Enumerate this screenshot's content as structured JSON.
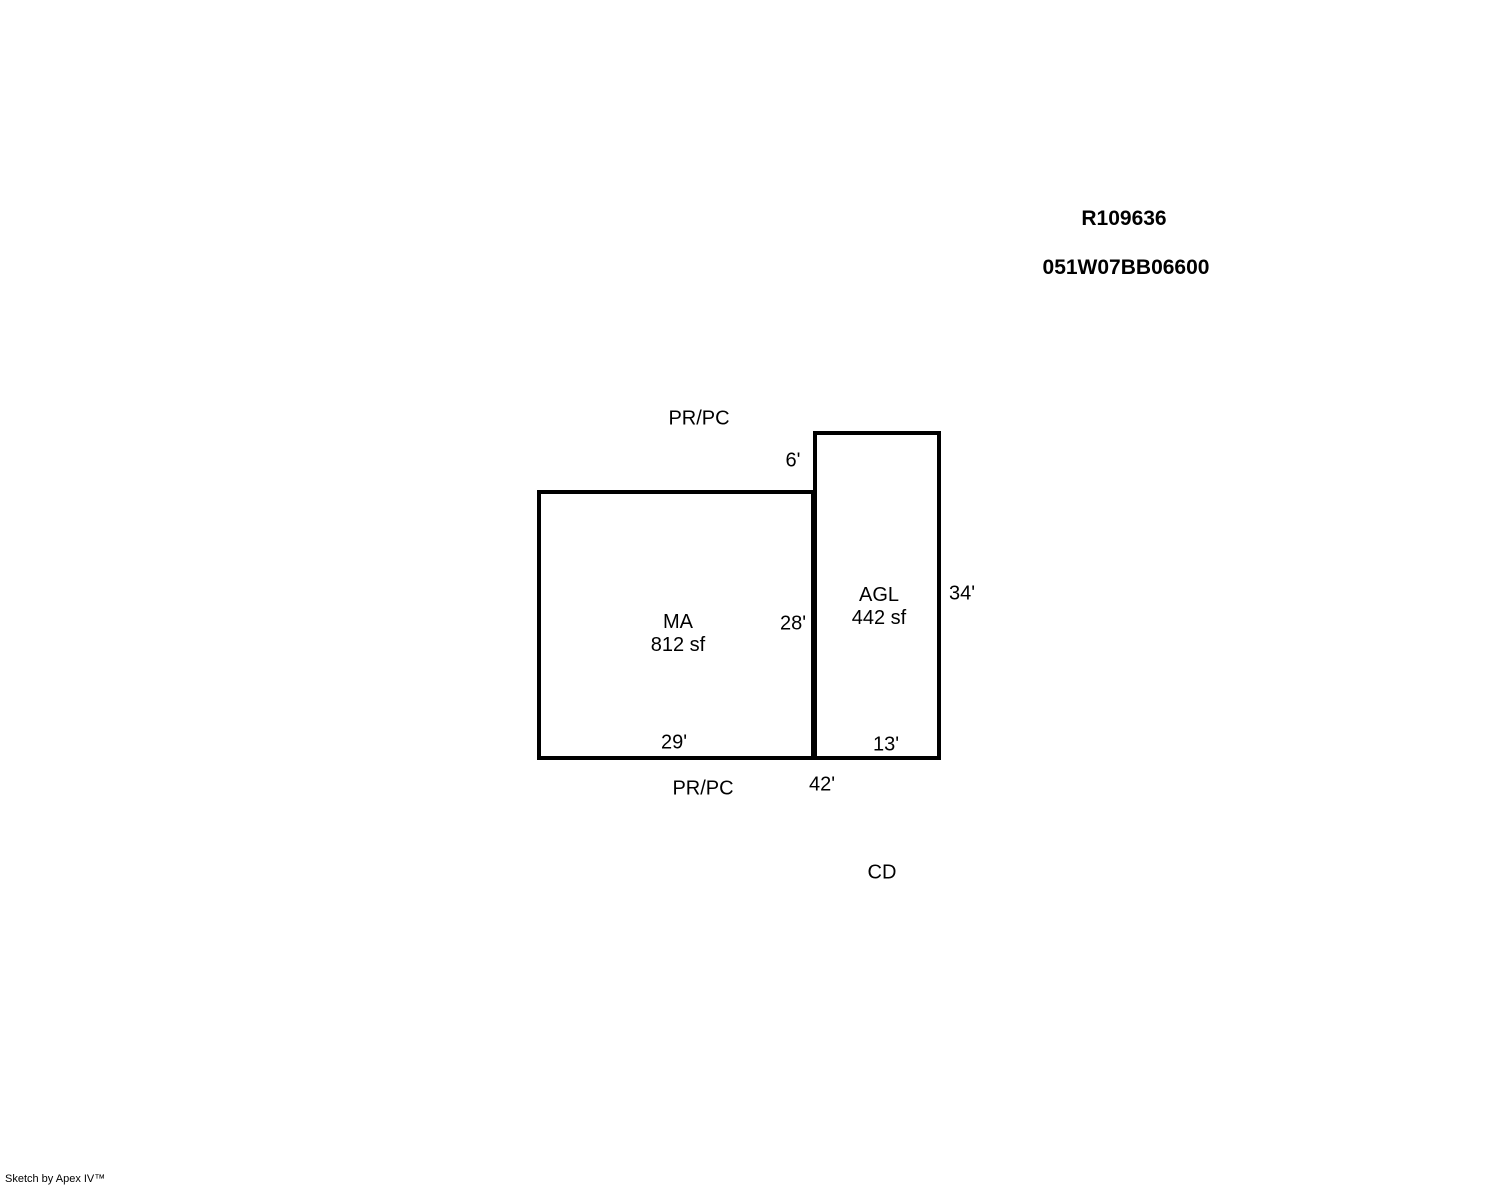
{
  "page": {
    "background_color": "#ffffff",
    "line_color": "#000000"
  },
  "header": {
    "record_id": "R109636",
    "parcel_id": "051W07BB06600"
  },
  "sketch": {
    "areas": [
      {
        "code": "MA",
        "size": "812 sf"
      },
      {
        "code": "AGL",
        "size": "442 sf"
      }
    ],
    "boundary_labels": {
      "top": "PR/PC",
      "bottom": "PR/PC",
      "cd": "CD"
    },
    "dimensions": {
      "agl_top_offset": "6'",
      "ma_right": "28'",
      "ma_bottom": "29'",
      "agl_right": "34'",
      "agl_bottom": "13'",
      "total_bottom": "42'"
    }
  },
  "footer": {
    "credit": "Sketch by Apex IV™"
  }
}
